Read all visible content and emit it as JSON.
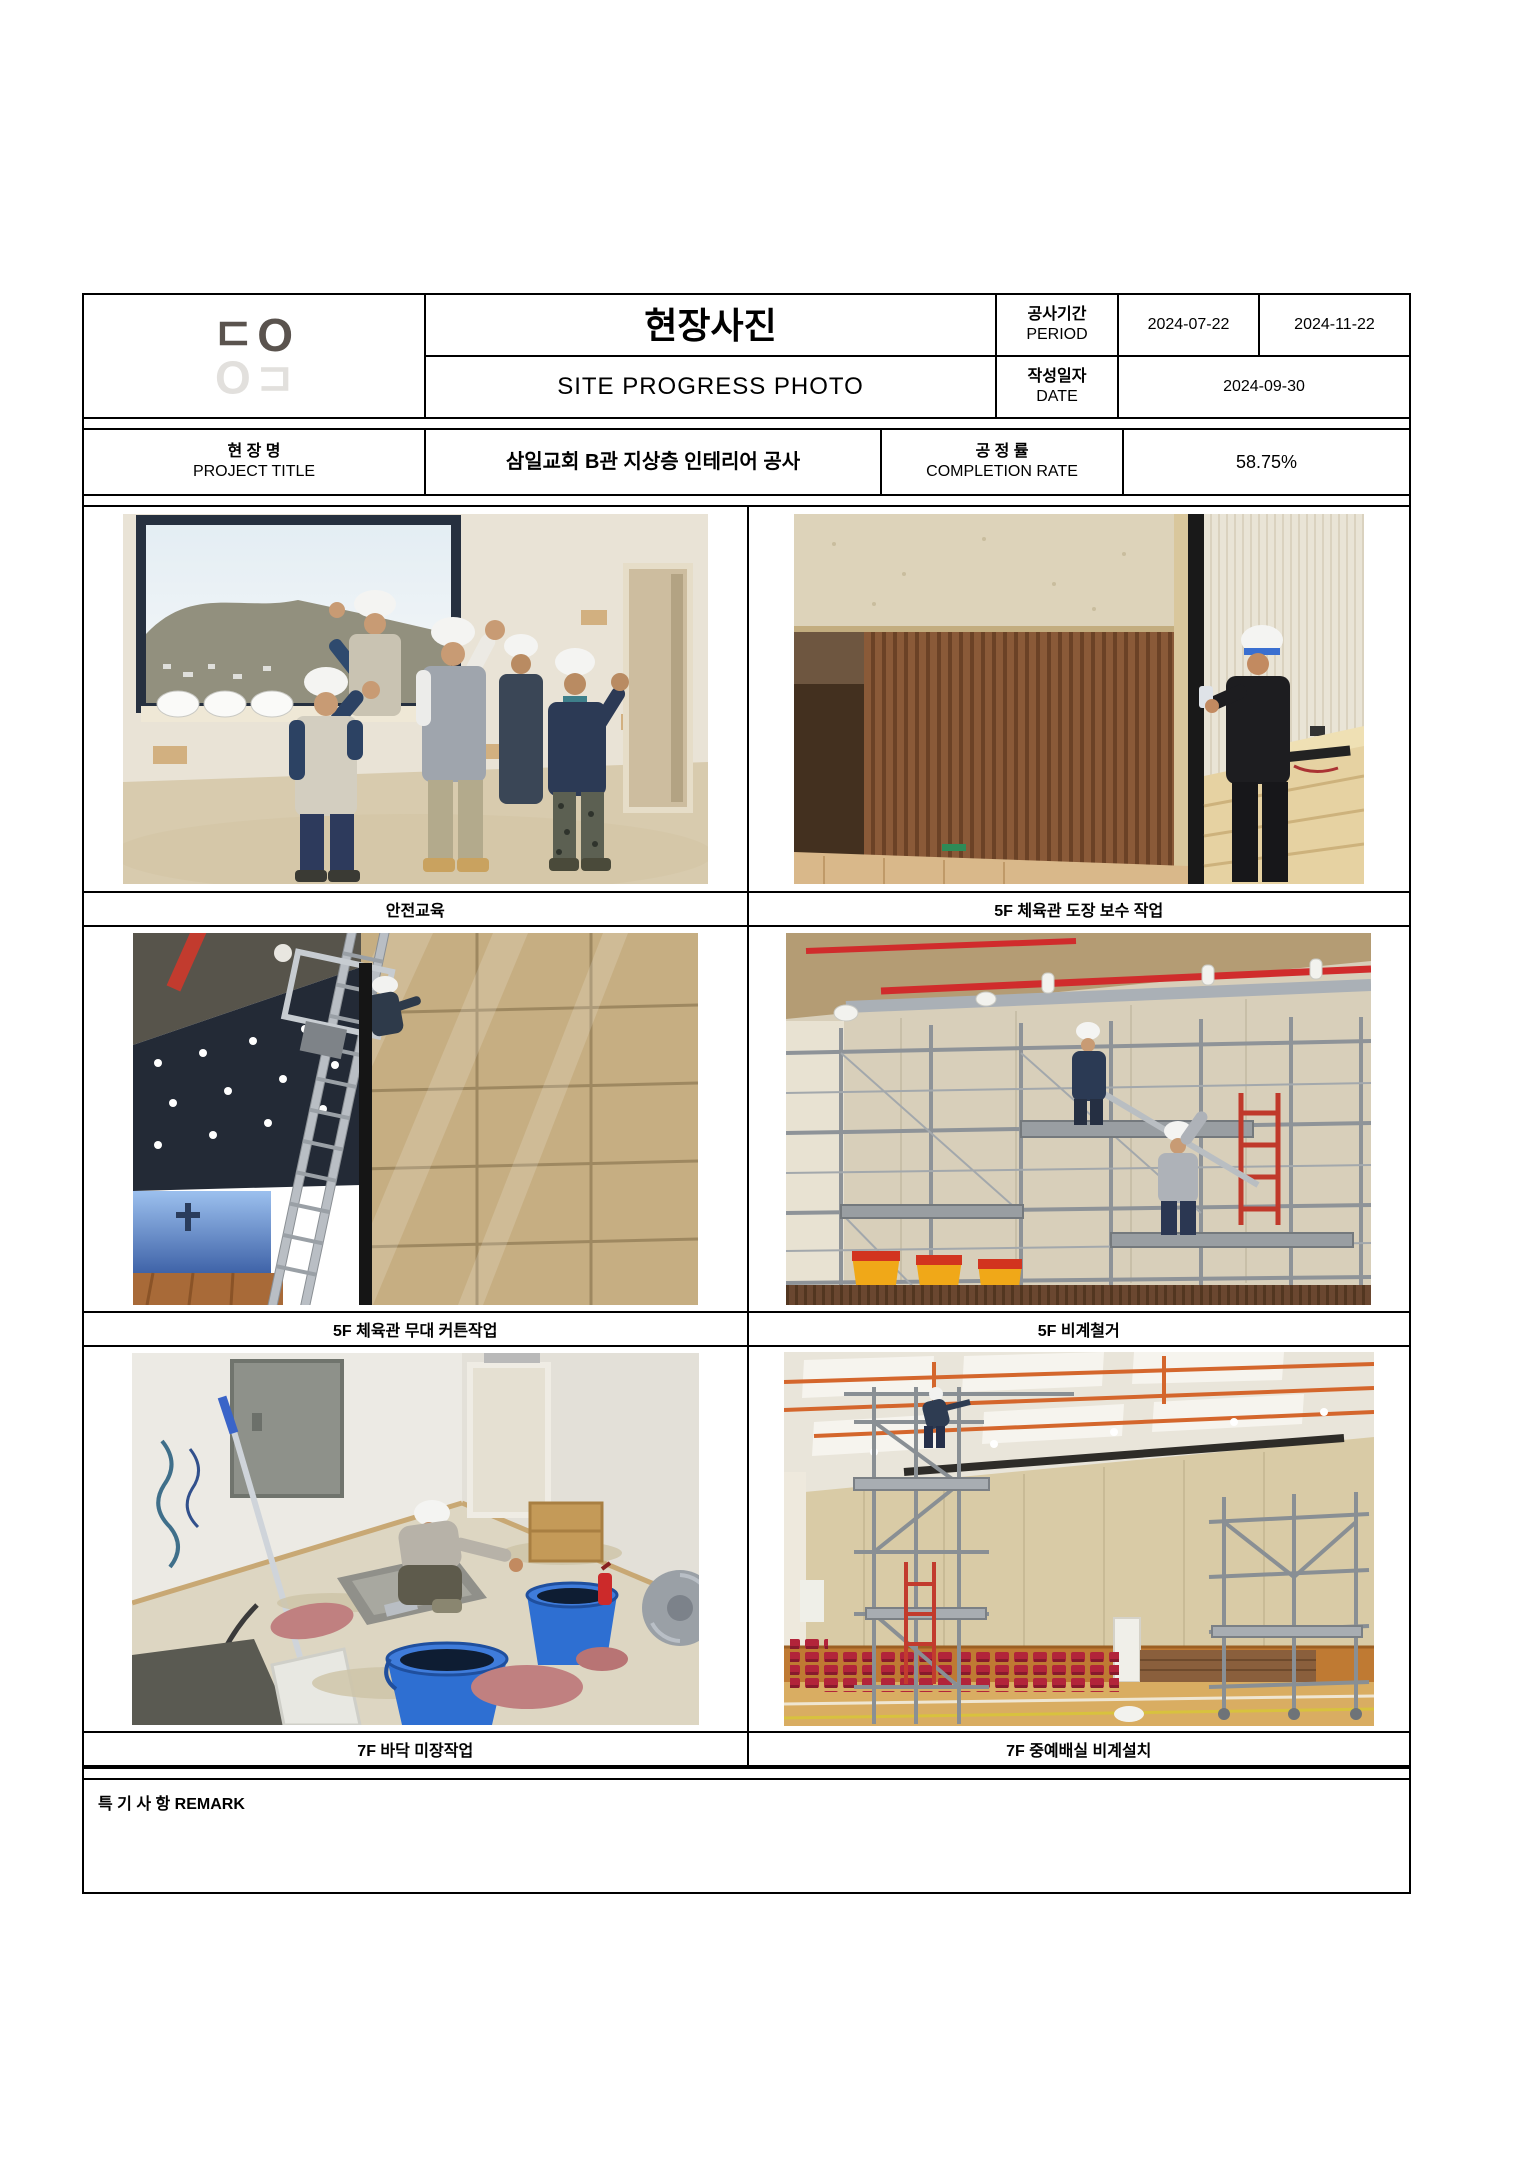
{
  "logo": {
    "text": "ㄷO",
    "dark_color": "#5a534e",
    "light_color": "#e2e0dd"
  },
  "header": {
    "title_ko": "현장사진",
    "title_en": "SITE PROGRESS PHOTO",
    "period_label_ko": "공사기간",
    "period_label_en": "PERIOD",
    "period_start": "2024-07-22",
    "period_end": "2024-11-22",
    "date_label_ko": "작성일자",
    "date_label_en": "DATE",
    "date_value": "2024-09-30",
    "project_label_ko": "현 장 명",
    "project_label_en": "PROJECT TITLE",
    "project_title": "삼일교회 B관 지상층 인테리어 공사",
    "completion_label_ko": "공 정 률",
    "completion_label_en": "COMPLETION RATE",
    "completion_value": "58.75%"
  },
  "photos": [
    {
      "caption": "안전교육"
    },
    {
      "caption": "5F 체육관 도장 보수 작업"
    },
    {
      "caption": "5F 체육관 무대 커튼작업"
    },
    {
      "caption": "5F 비계철거"
    },
    {
      "caption": "7F 바닥 미장작업"
    },
    {
      "caption": "7F 중예배실 비계설치"
    }
  ],
  "remark": {
    "label": "특 기 사 항 REMARK",
    "content": ""
  }
}
